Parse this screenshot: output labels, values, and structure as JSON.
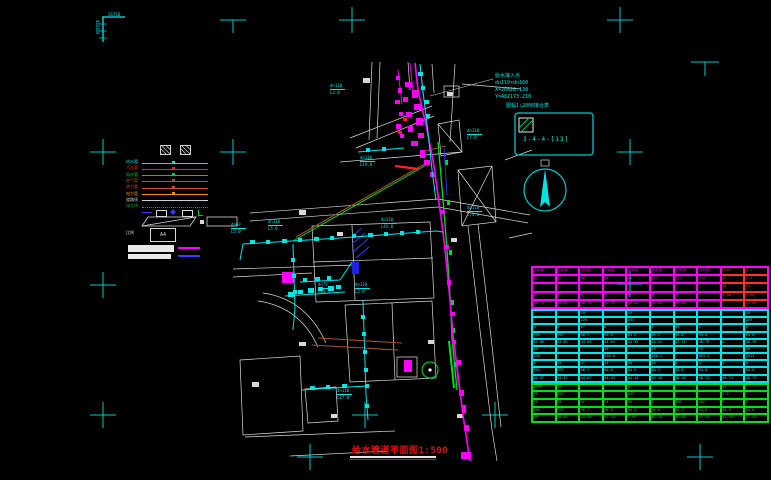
{
  "corner_mark": {
    "top_text": "26750",
    "side_text": "482100"
  },
  "survey_note": {
    "lines": [
      "给水接入点",
      "dn110×dn160",
      "X=26626.138",
      "Y=482173.218"
    ]
  },
  "index_box": {
    "caption": "图幅1:2000接合表",
    "label": "3-4-4-[13]"
  },
  "title": {
    "text": "给水管道平面图1:500"
  },
  "legend": {
    "scale_text": "比例",
    "paper_label": "A4",
    "items": [
      {
        "label": "给水管",
        "color": "#00e5e5",
        "style": "solid"
      },
      {
        "label": "污水管",
        "color": "#ff2020",
        "style": "solid"
      },
      {
        "label": "雨水管",
        "color": "#00cc33",
        "style": "solid"
      },
      {
        "label": "燃气管",
        "color": "#a0522d",
        "style": "solid"
      },
      {
        "label": "热力管",
        "color": "#cc4444",
        "style": "solid"
      },
      {
        "label": "电力管",
        "color": "#ff8c00",
        "style": "solid"
      },
      {
        "label": "道路线",
        "color": "#cfcfcf",
        "style": "solid"
      },
      {
        "label": "绿化线",
        "color": "#00aa22",
        "style": "dotted"
      }
    ]
  },
  "pipe_labels": [
    {
      "size": "dn110",
      "len": "L3.0",
      "x": 330,
      "y": 84
    },
    {
      "size": "dn110",
      "len": "L19.0",
      "x": 360,
      "y": 156
    },
    {
      "size": "dn63",
      "len": "L5.0",
      "x": 231,
      "y": 223
    },
    {
      "size": "dn110",
      "len": "L5.0",
      "x": 268,
      "y": 220
    },
    {
      "size": "dn110",
      "len": "L45.0",
      "x": 381,
      "y": 218
    },
    {
      "size": "dn75",
      "len": "L11.5",
      "x": 318,
      "y": 283
    },
    {
      "size": "dn110",
      "len": "L2.0",
      "x": 355,
      "y": 283
    },
    {
      "size": "dn110",
      "len": "L7.0",
      "x": 467,
      "y": 129
    },
    {
      "size": "dn110",
      "len": "L75.0",
      "x": 467,
      "y": 206
    },
    {
      "size": "dn110",
      "len": "L17.0",
      "x": 337,
      "y": 389
    }
  ],
  "well_table": {
    "columns": 10,
    "sections": [
      {
        "name": "storm",
        "color": "#ff00ff",
        "red_cols": [
          8,
          9
        ],
        "red_color": "#ff3030",
        "row_h": 8.2,
        "rows": [
          [
            "污水井",
            "污水井",
            "污水井",
            "污水井",
            "污水井",
            "污水井",
            "污水井",
            "污水井",
            "F592",
            "6.1"
          ],
          [
            "W7",
            "W5",
            "W6",
            "W9",
            "W1",
            "FS1",
            "FS2",
            "FS4",
            "61",
            "2.1"
          ],
          [
            "",
            "",
            "",
            "",
            "",
            "",
            "",
            "",
            "34",
            "21"
          ],
          [
            "砼",
            "砼",
            "砼",
            "砼",
            "砼",
            "砼",
            "砼",
            "",
            "4.98",
            "4.96"
          ],
          [
            "48.74",
            "48.43",
            "48.73",
            "48.76",
            "48.81",
            "44.82",
            "44.04",
            "",
            "",
            "14.05"
          ]
        ]
      },
      {
        "name": "sewer",
        "color": "#00e5e5",
        "row_h": 7.2,
        "rows": [
          [
            "",
            "",
            "19",
            "",
            "19",
            "",
            "",
            "",
            "",
            "19"
          ],
          [
            "",
            "",
            "226",
            "",
            "283",
            "",
            "",
            "",
            "",
            "229"
          ],
          [
            "H",
            "A",
            "A",
            "A",
            "1",
            "1",
            "W1",
            "1",
            "",
            "X"
          ],
          [
            "F94",
            "F67",
            "96.7",
            "96.8",
            "84.5",
            "84.2",
            "94.8",
            "94.8",
            "",
            "94.8"
          ],
          [
            "44.06",
            "44.85",
            "44.84",
            "44.64",
            "44.94",
            "44.41",
            "47.11",
            "48.79",
            "m",
            "48.39"
          ],
          [
            "19",
            "",
            "",
            "19",
            "",
            "19",
            "",
            "19",
            "",
            "19"
          ],
          [
            "539",
            "",
            "",
            "538.0",
            "",
            "380.1",
            "",
            "853.2",
            "",
            "2513"
          ],
          [
            "4",
            "14",
            "4",
            "74",
            "94",
            "34",
            "4",
            "4",
            "4",
            "4"
          ],
          [
            "F94",
            "F67",
            "96.7",
            "96.8",
            "84.5",
            "84.2",
            "94.8",
            "94.8",
            "",
            "94.8"
          ],
          [
            "44.07",
            "44.47",
            "44.07",
            "44.43",
            "44.43",
            "44.10",
            "48.10",
            "48.71",
            "48.74",
            "48.79"
          ]
        ]
      },
      {
        "name": "water",
        "color": "#00dd22",
        "row_h": 7.6,
        "rows": [
          [
            "4999",
            "99",
            "",
            "",
            "97",
            "",
            "",
            "",
            "97",
            ""
          ],
          [
            "F9",
            "D23",
            "",
            "",
            "533",
            "",
            "",
            "",
            "7.3",
            ""
          ],
          [
            "F9",
            "94",
            "91",
            "F4",
            "99",
            "4",
            "990",
            "497",
            "9",
            "F"
          ],
          [
            "F99",
            "F97",
            "96.7",
            "96.8",
            "94.5",
            "94.8",
            "94.4",
            "94.8",
            "94.9",
            "94.8"
          ],
          [
            "99",
            "48.45",
            "44.94",
            "47.24",
            "7.93",
            "47.24",
            "47.04",
            "47.52",
            "47.49",
            "17.53"
          ]
        ]
      }
    ]
  }
}
